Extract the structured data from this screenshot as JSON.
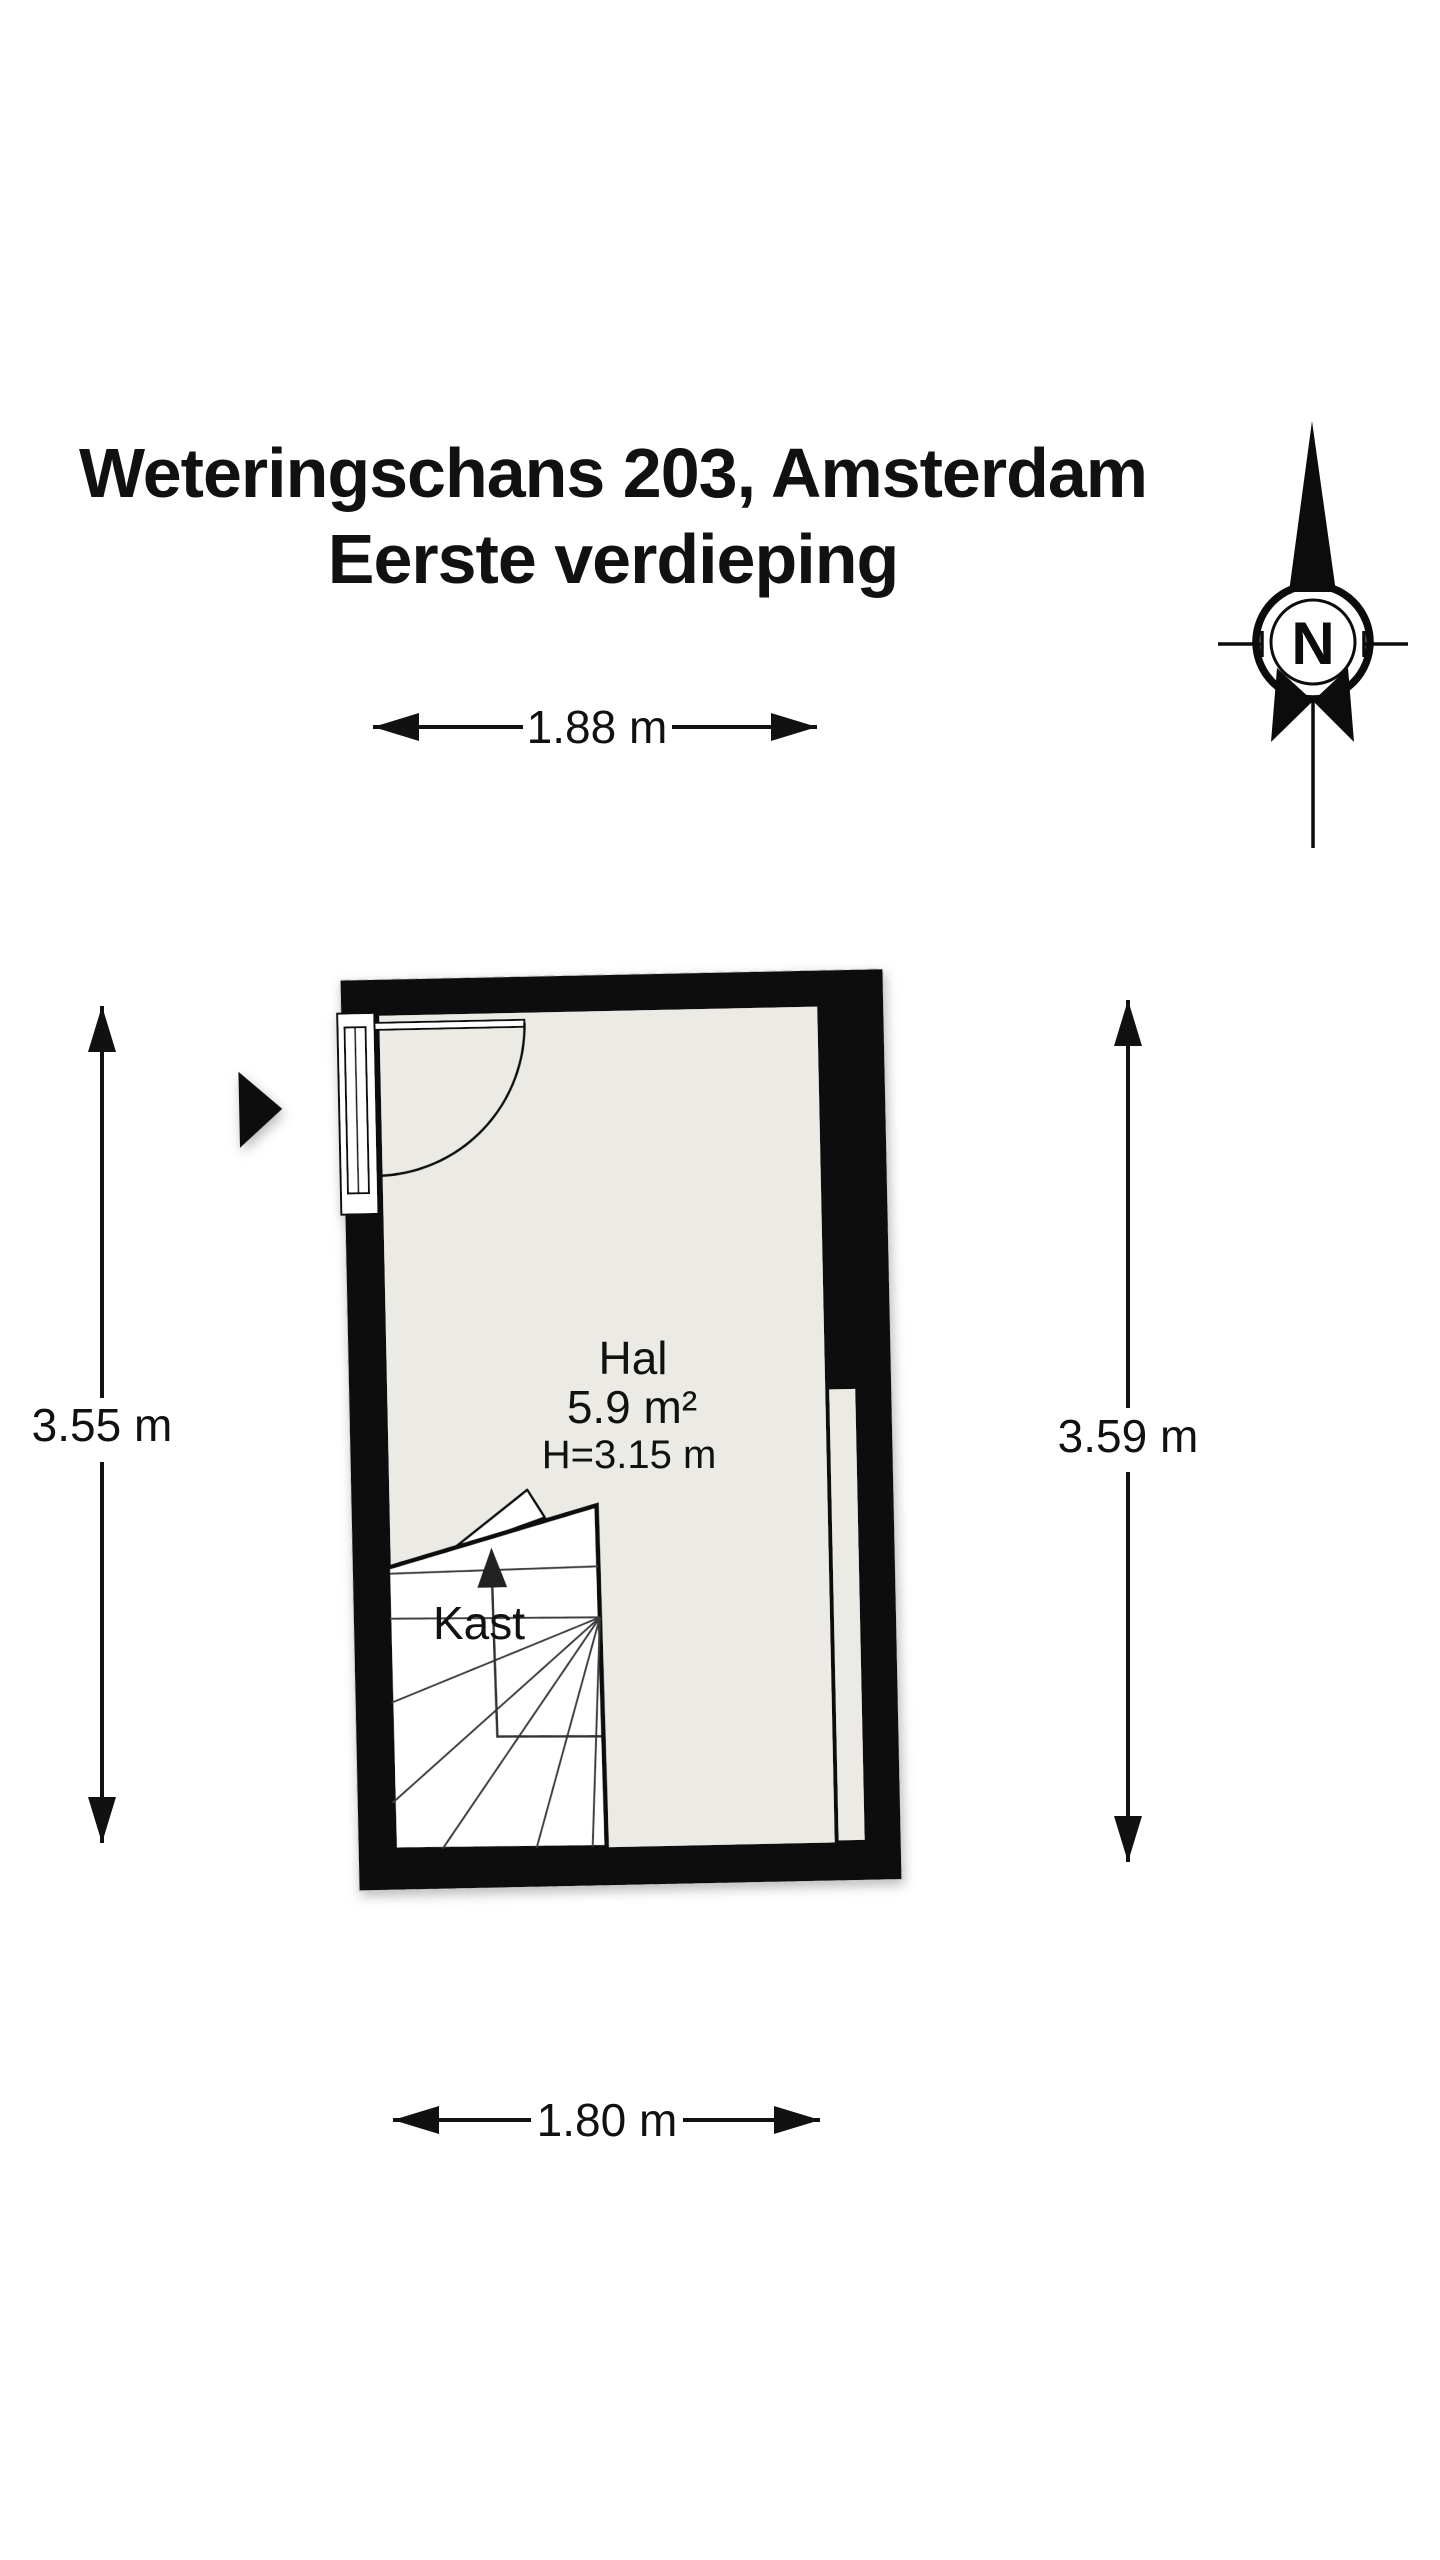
{
  "title": {
    "line1": "Weteringschans 203, Amsterdam",
    "line2": "Eerste verdieping"
  },
  "room": {
    "name": "Hal",
    "area": "5.9 m²",
    "ceiling_height": "H=3.15 m"
  },
  "closet": {
    "label": "Kast"
  },
  "dimensions": {
    "top": "1.88 m",
    "bottom": "1.80 m",
    "left": "3.55 m",
    "right": "3.59 m"
  },
  "compass": {
    "north_label": "N"
  },
  "colors": {
    "background": "#ffffff",
    "wall": "#0a0a0a",
    "floor": "#eceae5",
    "line": "#111111"
  }
}
